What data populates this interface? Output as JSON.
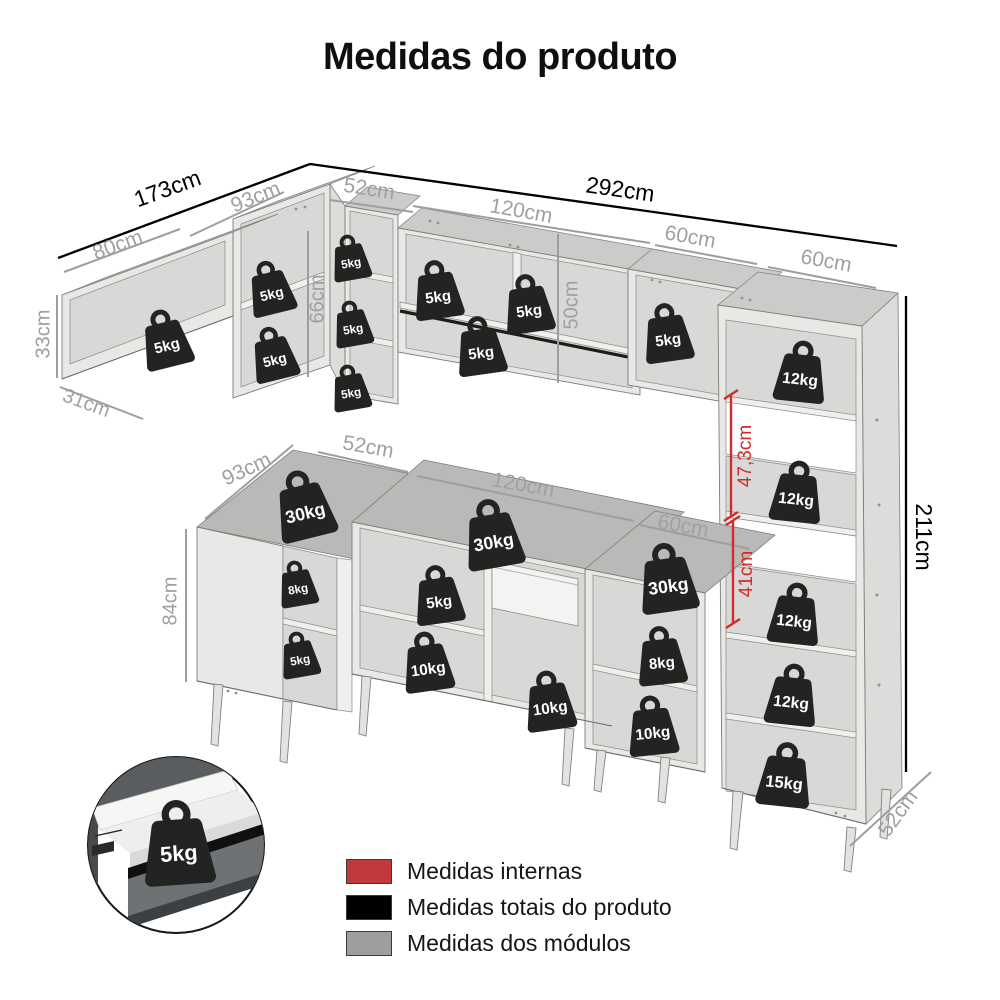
{
  "title": "Medidas do produto",
  "legend": {
    "items": [
      {
        "label": "Medidas internas",
        "color": "#c2393c"
      },
      {
        "label": "Medidas totais do produto",
        "color": "#000000"
      },
      {
        "label": "Medidas dos módulos",
        "color": "#9e9e9e"
      }
    ]
  },
  "measurement_colors": {
    "internal": "#d22c2c",
    "total": "#000000",
    "module": "#a0a0a0"
  },
  "dimension_labels": [
    {
      "text": "173cm",
      "kind": "total",
      "x": 168,
      "y": 190,
      "rot": -20,
      "size": 23
    },
    {
      "text": "292cm",
      "kind": "total",
      "x": 620,
      "y": 191,
      "rot": 8,
      "size": 23
    },
    {
      "text": "211cm",
      "kind": "total",
      "x": 922,
      "y": 537,
      "rot": 90,
      "size": 23
    },
    {
      "text": "80cm",
      "kind": "module",
      "x": 118,
      "y": 246,
      "rot": -20,
      "size": 21
    },
    {
      "text": "93cm",
      "kind": "module",
      "x": 256,
      "y": 198,
      "rot": -22,
      "size": 21
    },
    {
      "text": "52cm",
      "kind": "module",
      "x": 369,
      "y": 190,
      "rot": 9,
      "size": 21
    },
    {
      "text": "120cm",
      "kind": "module",
      "x": 521,
      "y": 212,
      "rot": 10,
      "size": 21
    },
    {
      "text": "60cm",
      "kind": "module",
      "x": 690,
      "y": 238,
      "rot": 10,
      "size": 21
    },
    {
      "text": "60cm",
      "kind": "module",
      "x": 826,
      "y": 262,
      "rot": 10,
      "size": 21
    },
    {
      "text": "33cm",
      "kind": "module",
      "x": 44,
      "y": 334,
      "rot": -90,
      "size": 20
    },
    {
      "text": "31cm",
      "kind": "module",
      "x": 86,
      "y": 404,
      "rot": 20,
      "size": 20
    },
    {
      "text": "66cm",
      "kind": "module",
      "x": 318,
      "y": 299,
      "rot": -90,
      "size": 20
    },
    {
      "text": "50cm",
      "kind": "module",
      "x": 572,
      "y": 305,
      "rot": -90,
      "size": 20
    },
    {
      "text": "93cm",
      "kind": "module",
      "x": 247,
      "y": 470,
      "rot": -25,
      "size": 21
    },
    {
      "text": "52cm",
      "kind": "module",
      "x": 368,
      "y": 448,
      "rot": 10,
      "size": 21
    },
    {
      "text": "120cm",
      "kind": "module",
      "x": 523,
      "y": 486,
      "rot": 10,
      "size": 21
    },
    {
      "text": "60cm",
      "kind": "module",
      "x": 683,
      "y": 527,
      "rot": 10,
      "size": 21
    },
    {
      "text": "84cm",
      "kind": "module",
      "x": 171,
      "y": 601,
      "rot": -90,
      "size": 20
    },
    {
      "text": "52cm",
      "kind": "module",
      "x": 899,
      "y": 814,
      "rot": -54,
      "size": 21
    },
    {
      "text": "47,3cm",
      "kind": "internal",
      "x": 746,
      "y": 456,
      "rot": -90,
      "size": 19
    },
    {
      "text": "41cm",
      "kind": "internal",
      "x": 747,
      "y": 574,
      "rot": -90,
      "size": 19
    }
  ],
  "weight_badges": [
    {
      "text": "5kg",
      "x": 165,
      "y": 338,
      "s": 1,
      "rot": -14
    },
    {
      "text": "5kg",
      "x": 270,
      "y": 287,
      "s": 0.92,
      "rot": -14
    },
    {
      "text": "5kg",
      "x": 273,
      "y": 353,
      "s": 0.92,
      "rot": -14
    },
    {
      "text": "5kg",
      "x": 350,
      "y": 257,
      "s": 0.78,
      "rot": -10
    },
    {
      "text": "5kg",
      "x": 352,
      "y": 323,
      "s": 0.78,
      "rot": -10
    },
    {
      "text": "5kg",
      "x": 350,
      "y": 387,
      "s": 0.78,
      "rot": -10
    },
    {
      "text": "5kg",
      "x": 437,
      "y": 289,
      "s": 1,
      "rot": -8
    },
    {
      "text": "5kg",
      "x": 528,
      "y": 303,
      "s": 1,
      "rot": -8
    },
    {
      "text": "5kg",
      "x": 480,
      "y": 345,
      "s": 1,
      "rot": -8
    },
    {
      "text": "5kg",
      "x": 667,
      "y": 332,
      "s": 1,
      "rot": -8
    },
    {
      "text": "12kg",
      "x": 801,
      "y": 371,
      "s": 1.05,
      "rot": 6
    },
    {
      "text": "12kg",
      "x": 797,
      "y": 491,
      "s": 1.05,
      "rot": 6
    },
    {
      "text": "12kg",
      "x": 795,
      "y": 613,
      "s": 1.05,
      "rot": 6
    },
    {
      "text": "12kg",
      "x": 792,
      "y": 694,
      "s": 1.05,
      "rot": 6
    },
    {
      "text": "15kg",
      "x": 785,
      "y": 774,
      "s": 1.1,
      "rot": 6
    },
    {
      "text": "30kg",
      "x": 303,
      "y": 504,
      "s": 1.18,
      "rot": -14
    },
    {
      "text": "30kg",
      "x": 492,
      "y": 533,
      "s": 1.18,
      "rot": -10
    },
    {
      "text": "30kg",
      "x": 667,
      "y": 577,
      "s": 1.18,
      "rot": -8
    },
    {
      "text": "8kg",
      "x": 297,
      "y": 583,
      "s": 0.78,
      "rot": -10
    },
    {
      "text": "5kg",
      "x": 299,
      "y": 654,
      "s": 0.78,
      "rot": -10
    },
    {
      "text": "5kg",
      "x": 438,
      "y": 594,
      "s": 1,
      "rot": -8
    },
    {
      "text": "10kg",
      "x": 427,
      "y": 661,
      "s": 1.02,
      "rot": -8
    },
    {
      "text": "10kg",
      "x": 549,
      "y": 700,
      "s": 1.02,
      "rot": -8
    },
    {
      "text": "8kg",
      "x": 661,
      "y": 655,
      "s": 1,
      "rot": -6
    },
    {
      "text": "10kg",
      "x": 652,
      "y": 725,
      "s": 1.02,
      "rot": -6
    },
    {
      "text": "5kg",
      "x": 178,
      "y": 842,
      "s": 1.45,
      "rot": -4
    }
  ],
  "inset": {
    "description": "open-drawer-detail",
    "weight_label": "5kg"
  }
}
